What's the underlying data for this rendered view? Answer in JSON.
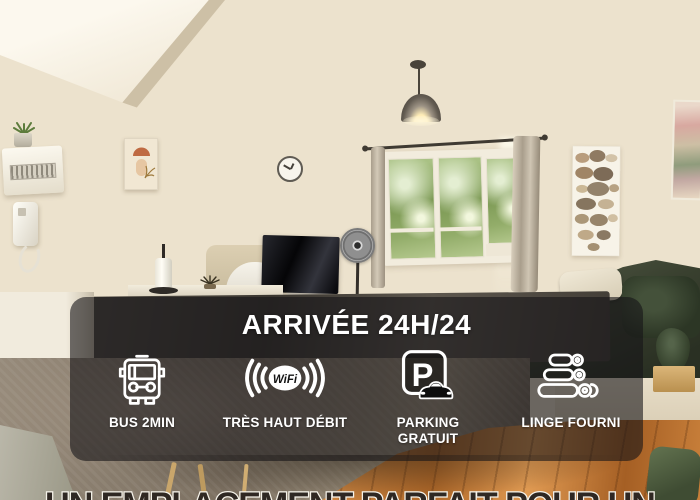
{
  "banner": {
    "title": "ARRIVÉE 24H/24",
    "panel_color": "rgba(22,20,24,0.60)",
    "text_color": "#ffffff",
    "features": [
      {
        "icon": "bus-icon",
        "label": "BUS 2MIN"
      },
      {
        "icon": "wifi-icon",
        "label": "TRÈS HAUT DÉBIT",
        "icon_text": "WiFi"
      },
      {
        "icon": "parking-icon",
        "label": "PARKING GRATUIT",
        "icon_text": "P"
      },
      {
        "icon": "folded-towels-icon",
        "label": "LINGE FOURNI"
      }
    ]
  },
  "caption": {
    "text": "UN EMPLACEMENT PARFAIT POUR UN",
    "fill_color": "#2f2823",
    "outline_color": "#f6f3ea"
  },
  "photo": {
    "description": "bright apartment living room with window onto trees",
    "objects": [
      "pendant-lamp",
      "triple-window",
      "curtains",
      "wall-clock",
      "flat-tv",
      "standing-fan",
      "white-chairs",
      "beige-headboard",
      "dark-table",
      "green-sofa",
      "beige-pillow",
      "pebble-art-poster",
      "abstract-wall-art",
      "intercom-handset",
      "fuse-box",
      "succulent-plant",
      "paper-towel-holder",
      "taupe-rug",
      "parquet-floor",
      "green-cushion",
      "wood-stool"
    ]
  }
}
